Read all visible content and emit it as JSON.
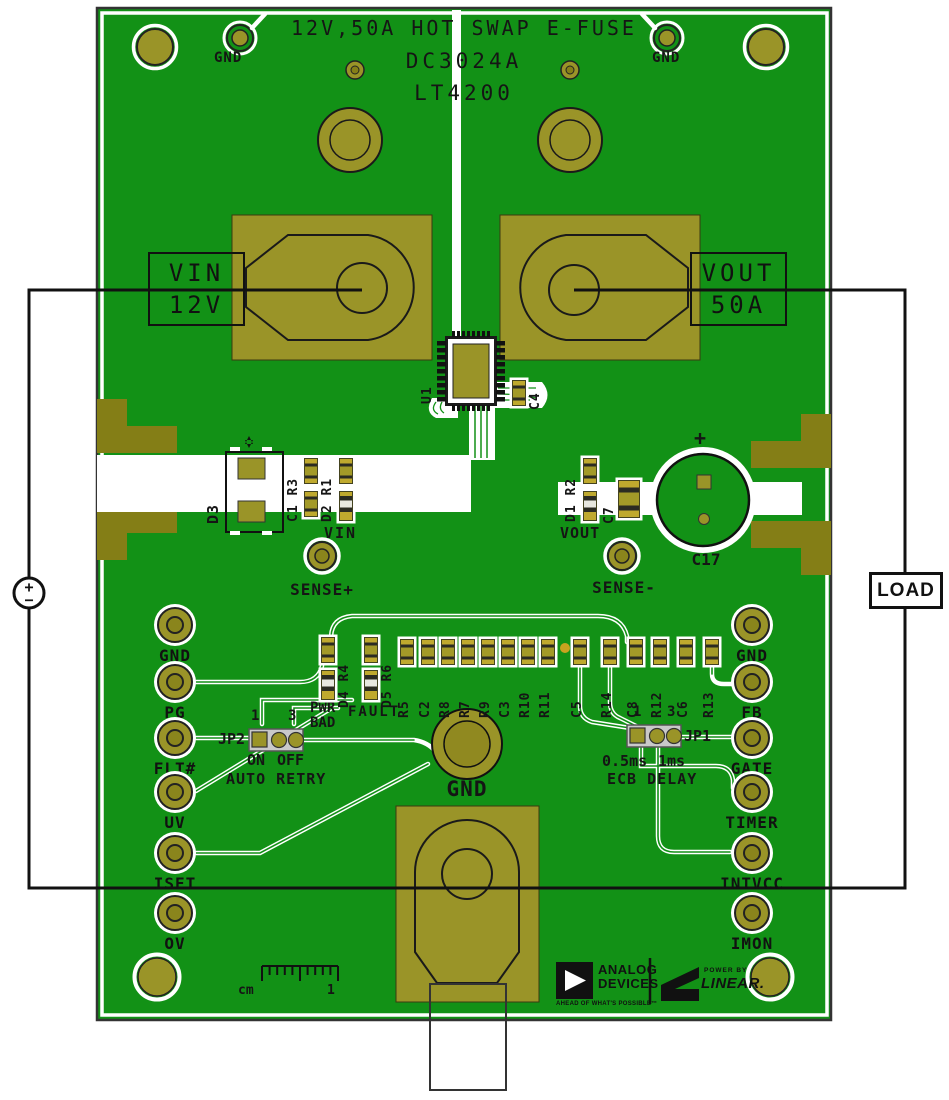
{
  "board_title": {
    "line1": "12V,50A HOT SWAP E-FUSE",
    "line2": "DC3024A",
    "line3": "LT4200"
  },
  "top": {
    "gnd_left": "GND",
    "gnd_right": "GND"
  },
  "vin_box": {
    "line1": "VIN",
    "line2": "12V"
  },
  "vout_box": {
    "line1": "VOUT",
    "line2": "50A"
  },
  "ic": {
    "ref": "U1",
    "cap": "C4"
  },
  "mid_left": {
    "diode": "D3",
    "pair1": "C1 R3",
    "pair2": "D2 R1",
    "node": "VIN",
    "sense": "SENSE+"
  },
  "mid_right": {
    "pair": "D1 R2",
    "cap": "C7",
    "node": "VOUT",
    "sense": "SENSE-",
    "bulk_cap": "C17",
    "polarity": "+"
  },
  "testpoints": {
    "left": [
      "GND",
      "PG",
      "FLT#",
      "UV",
      "ISET",
      "OV"
    ],
    "right": [
      "GND",
      "FB",
      "GATE",
      "TIMER",
      "INTVCC",
      "IMON"
    ]
  },
  "jp2": {
    "ref": "JP2",
    "pin1": "1",
    "pin3": "3",
    "opt_a": "ON",
    "opt_b": "OFF",
    "caption": "AUTO RETRY"
  },
  "jp1": {
    "ref": "JP1",
    "pin1": "1",
    "pin3": "3",
    "opt_a": "0.5ms",
    "opt_b": "1ms",
    "caption": "ECB DELAY"
  },
  "flags": {
    "pwr": "PWR",
    "bad": "BAD",
    "fault": "FAULT"
  },
  "component_row": {
    "pair1": "D4 R4",
    "pair2": "D5 R6",
    "singles": [
      "R5",
      "C2",
      "R8",
      "R7",
      "R9",
      "C3",
      "R10",
      "R11",
      "C5",
      "R14",
      "C8",
      "R12",
      "C6",
      "R13"
    ]
  },
  "center_pad": {
    "label": "GND"
  },
  "ruler": {
    "unit": "cm",
    "mark": "1"
  },
  "logos": {
    "adi_line1": "ANALOG",
    "adi_line2": "DEVICES",
    "adi_tagline": "AHEAD OF WHAT'S POSSIBLE™",
    "power_by": "POWER BY",
    "linear": "LINEAR."
  },
  "external": {
    "load": "LOAD",
    "source_plus": "+",
    "source_minus": "−"
  },
  "colors": {
    "pcb_green": "#129116",
    "pad_gold": "#9a9428",
    "plane_gold": "#847e16",
    "silkscreen": "#ffffff",
    "wire_black": "#111111"
  }
}
